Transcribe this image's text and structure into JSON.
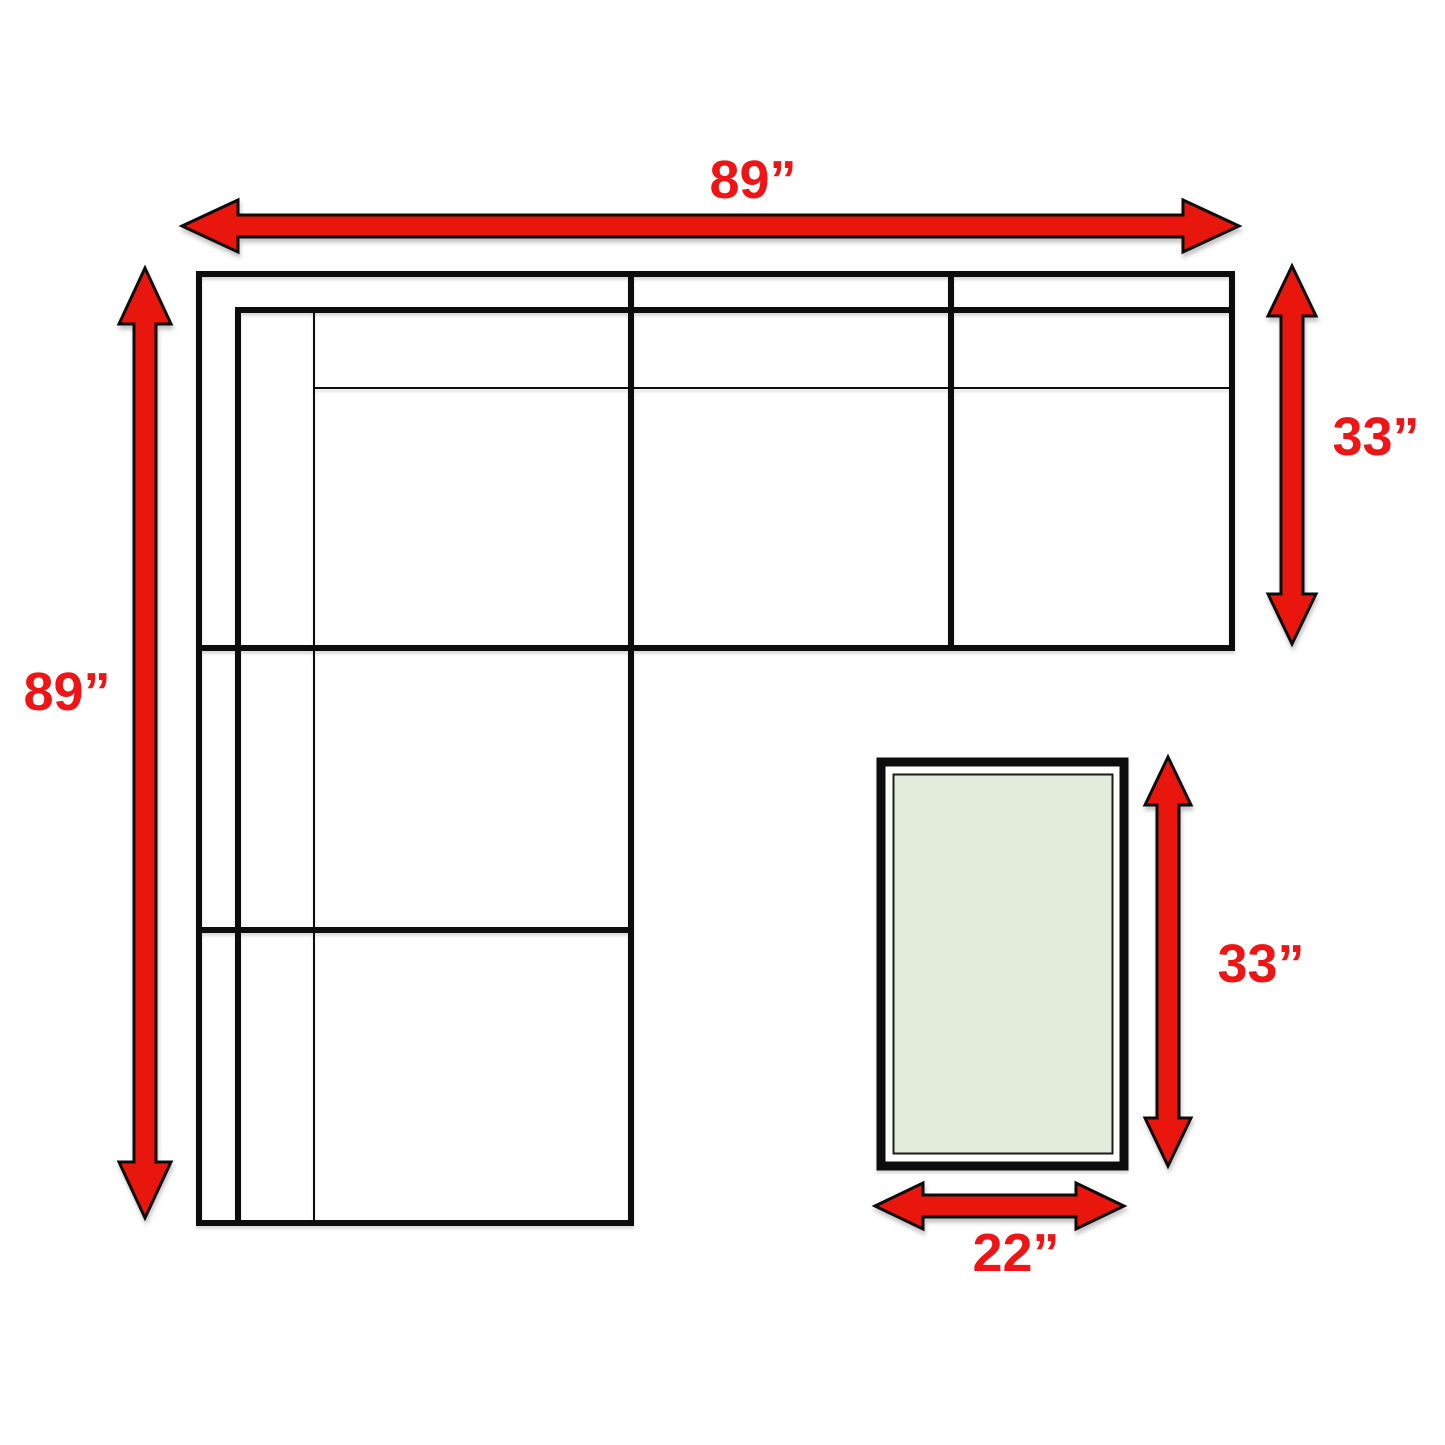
{
  "sectional": {
    "width_label": "89”",
    "depth_left_label": "89”",
    "depth_right_label": "33”"
  },
  "ottoman": {
    "depth_label": "33”",
    "width_label": "22”"
  },
  "colors": {
    "arrow-red": "#e8120e",
    "label-red": "#ed1515",
    "line-black": "#0c0c0c",
    "ottoman-fill": "#e3ecda",
    "canvas-bg": "#ffffff"
  }
}
